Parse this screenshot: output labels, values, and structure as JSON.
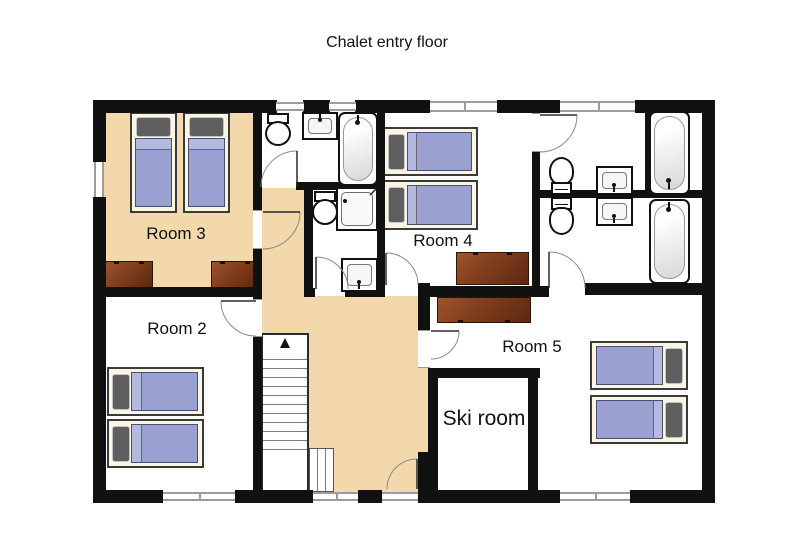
{
  "title": "Chalet entry floor",
  "rooms": [
    {
      "id": "room3",
      "label": "Room 3",
      "beds": 2,
      "desks": 2
    },
    {
      "id": "room2",
      "label": "Room 2",
      "beds": 2,
      "desks": 0
    },
    {
      "id": "room4",
      "label": "Room 4",
      "beds": 2,
      "desks": 1
    },
    {
      "id": "room5",
      "label": "Room 5",
      "beds": 2,
      "desks": 1
    },
    {
      "id": "ski_room",
      "label": "Ski room",
      "beds": 0,
      "desks": 0
    }
  ],
  "fixtures": {
    "toilets": 4,
    "sinks": 4,
    "bathtubs": 3,
    "showers": 1,
    "staircases": 1
  },
  "colors": {
    "wall": "#111111",
    "floor_tan": "#f2d8ab",
    "bed_mattress": "#9aa0d0",
    "bed_pillow": "#5f5f5f",
    "bed_frame": "#fbf6e3",
    "desk_brown": "#7a3414",
    "window_gray": "#9c9c9c",
    "background": "#ffffff"
  }
}
